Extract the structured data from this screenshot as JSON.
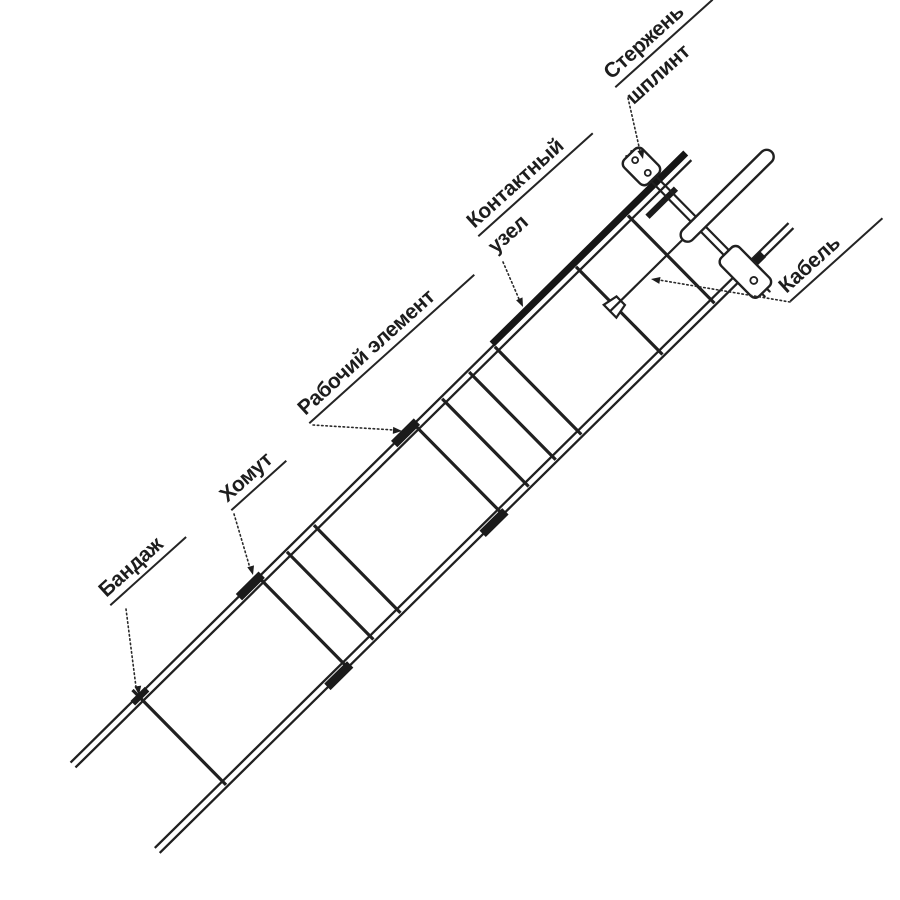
{
  "page": {
    "background": "#ffffff",
    "ink": "#1d1d1d"
  },
  "diagram": {
    "type": "technical-line-diagram",
    "labels": {
      "bandazh": "Бандаж",
      "khomut": "Хомут",
      "rabochiy_element": "Рабочий элемент",
      "kontaktny_uzel_line1": "Контактный",
      "kontaktny_uzel_line2": "узел",
      "sterzhen_shplint_line1": "Стержень",
      "sterzhen_shplint_line2": "шплинт",
      "kabel": "Кабель"
    }
  }
}
